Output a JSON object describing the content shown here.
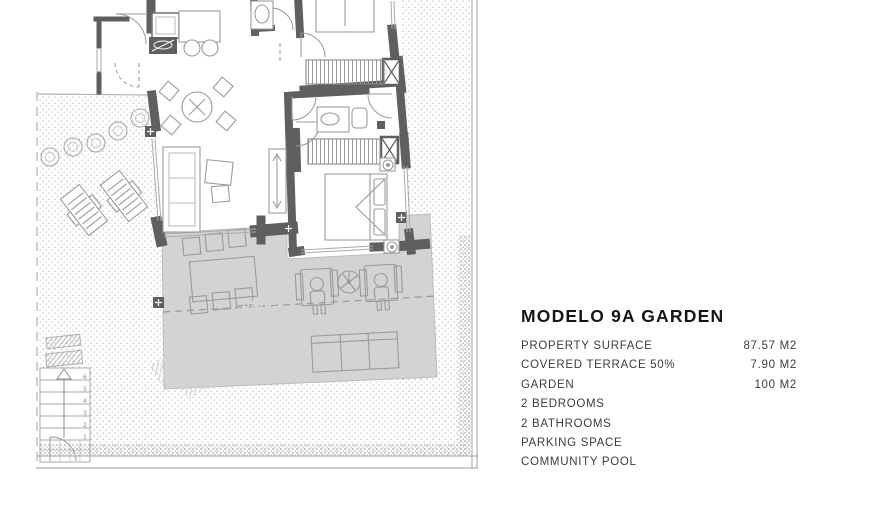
{
  "window": {
    "background": "#ffffff"
  },
  "info_panel": {
    "title": "MODELO 9A GARDEN",
    "rows": [
      {
        "label": "PROPERTY SURFACE",
        "value": "87.57 M2"
      },
      {
        "label": "COVERED TERRACE 50%",
        "value": "7.90 M2"
      },
      {
        "label": "GARDEN",
        "value": "100 M2"
      },
      {
        "label": "2 BEDROOMS",
        "value": ""
      },
      {
        "label": "2 BATHROOMS",
        "value": ""
      },
      {
        "label": "PARKING SPACE",
        "value": ""
      },
      {
        "label": "COMMUNITY POOL",
        "value": ""
      }
    ]
  },
  "floor_plan": {
    "stairs": {
      "step_labels": [
        "1",
        "2",
        "3",
        "4",
        "5",
        "6"
      ]
    },
    "colors": {
      "walls": "#5f5f5f",
      "terrace_floor": "#d3d3d3",
      "furniture_outline": "#9a9a9a",
      "garden_dots": "#c9c9c9",
      "boundary_line": "#b0b0b0"
    }
  }
}
